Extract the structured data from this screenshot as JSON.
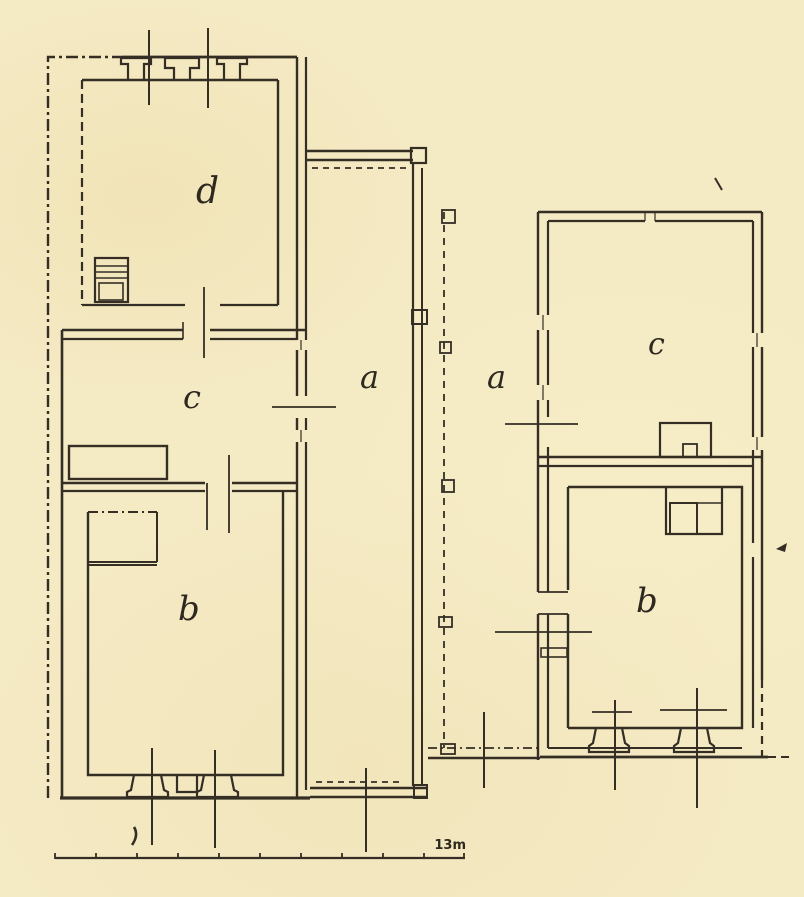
{
  "plan": {
    "left_building": {
      "room_d_label": "d",
      "room_c_label": "c",
      "room_b_label": "b"
    },
    "courtyard": {
      "left_label": "a",
      "right_label": "a"
    },
    "right_building": {
      "room_c_label": "c",
      "room_b_label": "b"
    },
    "scale_bar": {
      "label": "13m"
    }
  },
  "colors": {
    "paper": "#f4eac4",
    "ink": "#342e25"
  }
}
